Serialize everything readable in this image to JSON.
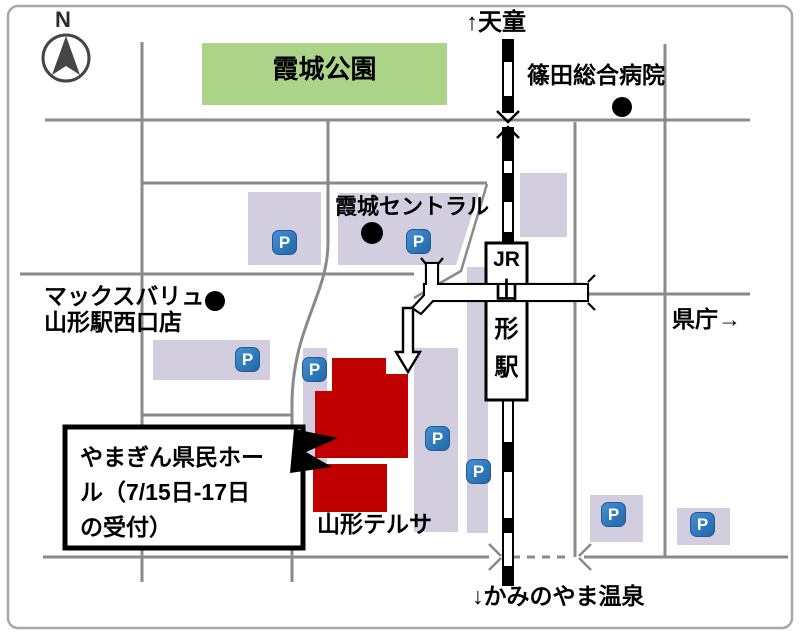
{
  "map": {
    "compass_label": "N",
    "directions": {
      "north": "↑天童",
      "south": "↓かみのやま温泉",
      "east": "県庁→"
    },
    "places": {
      "park": "霞城公園",
      "hospital": "篠田総合病院",
      "kajo_central": "霞城セントラル",
      "maxvalu_line1": "マックスバリュ",
      "maxvalu_line2": "山形駅西口店",
      "terusa": "山形テルサ"
    },
    "station": {
      "jr": "JR",
      "chars": [
        "山",
        "形",
        "駅"
      ]
    },
    "callout": {
      "line1": "やまぎん県民ホー",
      "line2": "ル（7/15日-17日",
      "line3": "の受付）"
    },
    "parking_label": "P",
    "colors": {
      "building_lavender": "#d3cde0",
      "park_green": "#abd489",
      "hall_red": "#c00000",
      "parking_blue": "#2e79bd",
      "road_gray": "#8a8a8a",
      "railway_black": "#000000"
    }
  }
}
